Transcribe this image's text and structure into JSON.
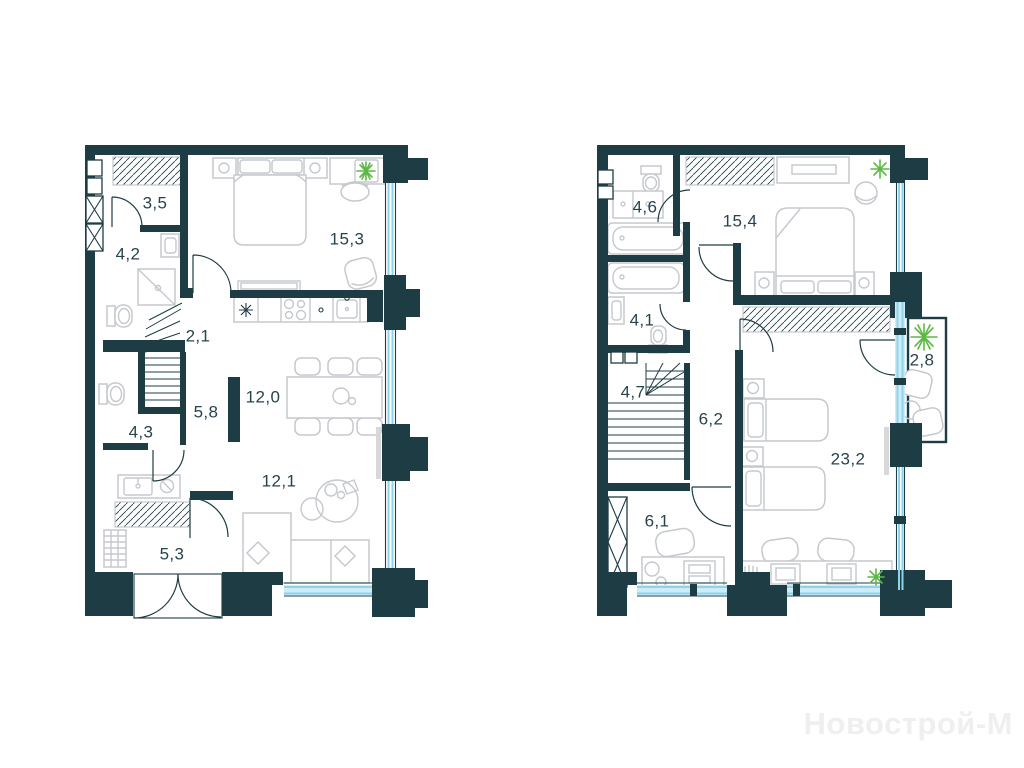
{
  "watermark": {
    "text": "Новострой-М"
  },
  "colors": {
    "wall": "#1e3c43",
    "window_glass": "#8ed3ec",
    "window_fill": "#cdecf8",
    "furniture_outline": "#c5c9cd",
    "room_label": "#27444c",
    "plant": "#5cb944",
    "sill": "#d8d8d8",
    "watermark": "#efefef",
    "background": "#ffffff"
  },
  "floor1": {
    "rooms": [
      {
        "id": "hall",
        "area": "3,5"
      },
      {
        "id": "bathroom",
        "area": "4,2"
      },
      {
        "id": "bedroom",
        "area": "15,3"
      },
      {
        "id": "stairs",
        "area": "2,1"
      },
      {
        "id": "kitchen-dining",
        "area": "12,0"
      },
      {
        "id": "corridor",
        "area": "5,8"
      },
      {
        "id": "wc",
        "area": "4,3"
      },
      {
        "id": "living-room",
        "area": "12,1"
      },
      {
        "id": "pantry",
        "area": "5,3"
      }
    ]
  },
  "floor2": {
    "rooms": [
      {
        "id": "bathroom",
        "area": "4,6"
      },
      {
        "id": "bedroom",
        "area": "15,4"
      },
      {
        "id": "bathroom-2",
        "area": "4,1"
      },
      {
        "id": "balcony",
        "area": "2,8"
      },
      {
        "id": "stairs",
        "area": "4,7"
      },
      {
        "id": "hall",
        "area": "6,2"
      },
      {
        "id": "kids-room",
        "area": "23,2"
      },
      {
        "id": "office",
        "area": "6,1"
      }
    ]
  }
}
